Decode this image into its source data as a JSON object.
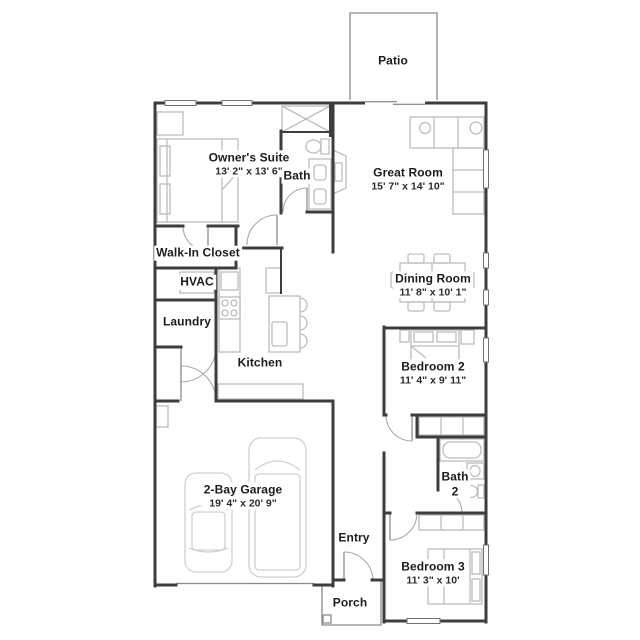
{
  "title": "Floor plan",
  "colors": {
    "wall": "#3d3d3d",
    "furniture": "#bdbdbd",
    "car": "#d0d0d0",
    "door_arc": "#a9a9a9",
    "window_frame": "#6f6f6f",
    "text": "#1c1c1c",
    "background": "#ffffff"
  },
  "rooms": {
    "patio": {
      "label": "Patio"
    },
    "owners_suite": {
      "label": "Owner's Suite",
      "dims": "13' 2\" x 13' 6\""
    },
    "bath": {
      "label": "Bath"
    },
    "great_room": {
      "label": "Great Room",
      "dims": "15' 7\" x 14' 10\""
    },
    "walk_in_closet": {
      "label": "Walk-In Closet"
    },
    "hvac": {
      "label": "HVAC"
    },
    "laundry": {
      "label": "Laundry"
    },
    "kitchen": {
      "label": "Kitchen"
    },
    "dining_room": {
      "label": "Dining Room",
      "dims": "11' 8\" x 10' 1\""
    },
    "bedroom_2": {
      "label": "Bedroom 2",
      "dims": "11' 4\" x 9' 11\""
    },
    "bath_2": {
      "label": "Bath",
      "label_line2": "2"
    },
    "garage": {
      "label": "2-Bay Garage",
      "dims": "19' 4\" x 20' 9\""
    },
    "entry": {
      "label": "Entry"
    },
    "bedroom_3": {
      "label": "Bedroom 3",
      "dims": "11' 3\" x 10'"
    },
    "porch": {
      "label": "Porch"
    }
  }
}
